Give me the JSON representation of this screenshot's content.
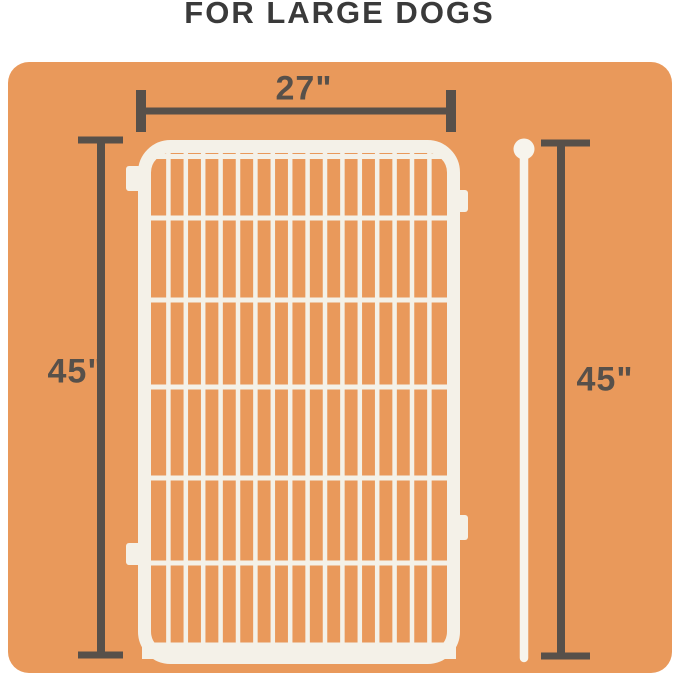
{
  "title": "FOR LARGE DOGS",
  "dimensions": {
    "width": "27\"",
    "height_left": "45\"",
    "height_right": "45\""
  },
  "graphics": {
    "panel": "white wire fence panel with connector tabs",
    "rod": "white ground stake rod with ball top"
  },
  "colors": {
    "page_background": "#ffffff",
    "card_background": "#e9995b",
    "panel_white": "#f4f1e8",
    "dimension_lines": "#57504a",
    "title_text": "#3a3a3a"
  }
}
